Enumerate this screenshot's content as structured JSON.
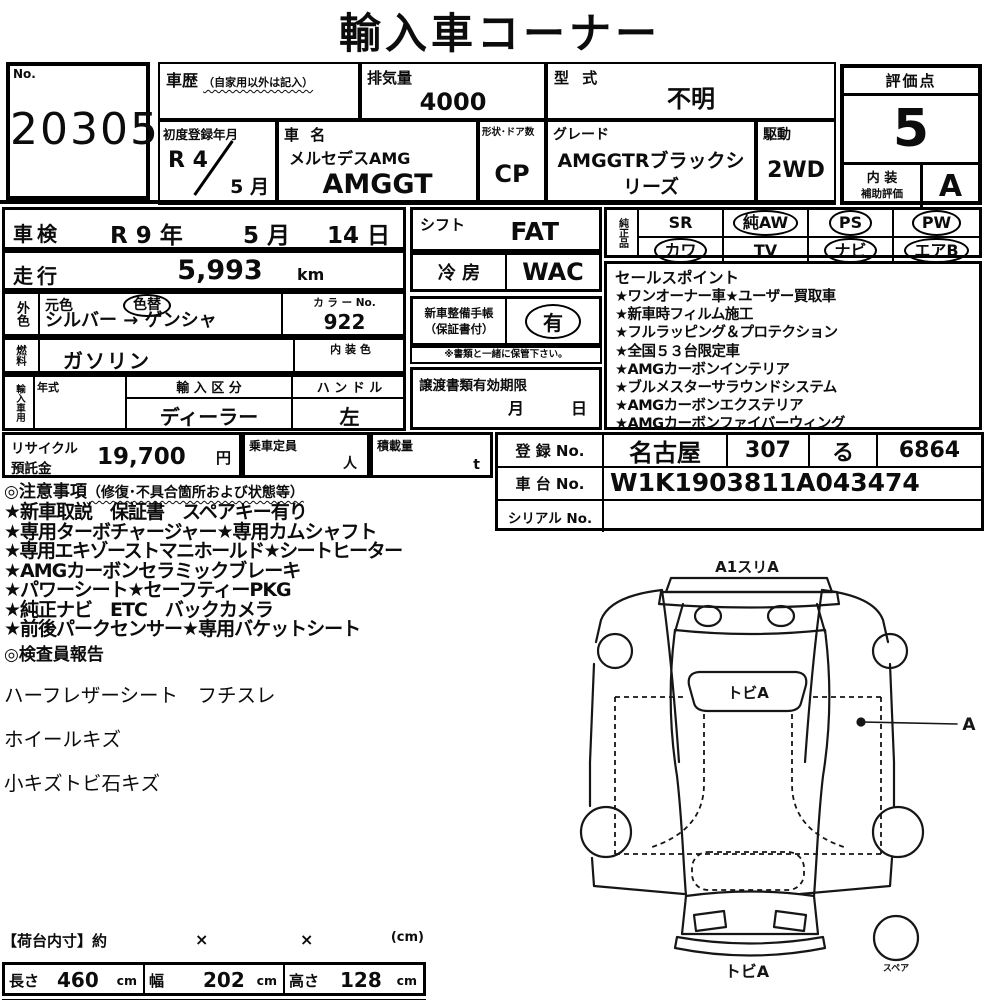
{
  "title": "輸入車コーナー",
  "no_box": {
    "label": "No.",
    "value": "20305"
  },
  "header": {
    "history": {
      "label": "車歴",
      "note": "（自家用以外は記入）",
      "value": ""
    },
    "displacement": {
      "label": "排気量",
      "value": "4000"
    },
    "model_code": {
      "label": "型 式",
      "value": "不明"
    },
    "first_reg": {
      "label": "初度登録年月",
      "year": "R 4",
      "month": "5 月"
    },
    "car_name": {
      "label": "車 名",
      "maker": "メルセデスAMG",
      "model": "AMGGT"
    },
    "body_doors": {
      "label": "形状･ドア数",
      "value": "CP"
    },
    "grade": {
      "label": "グレード",
      "value": "AMGGTRブラックシリーズ"
    },
    "drive": {
      "label": "駆動",
      "value": "2WD"
    }
  },
  "rating": {
    "label": "評価点",
    "score": "5",
    "interior_label1": "内 装",
    "interior_label2": "補助評価",
    "interior_score": "A"
  },
  "inspection": {
    "label": "車検",
    "year": "R 9 年",
    "month": "5 月",
    "day": "14 日"
  },
  "mileage": {
    "label": "走行",
    "value": "5,993",
    "unit": "km"
  },
  "exterior": {
    "label": "外色",
    "orig_label": "元色",
    "changed_badge": "色替",
    "value": "シルバー → ゲンシャ",
    "color_no_label": "カ ラ ー No.",
    "color_no": "922"
  },
  "fuel": {
    "label": "燃料",
    "value": "ガソリン",
    "interior_color_label": "内 装 色",
    "interior_color": ""
  },
  "import_info": {
    "label": "輸入車用",
    "year_label": "年式",
    "year": "",
    "kubun_label": "輸 入 区 分",
    "kubun": "ディーラー",
    "handle_label": "ハ ン ド ル",
    "handle": "左"
  },
  "shift": {
    "label": "シフト",
    "value": "FAT"
  },
  "aircon": {
    "label": "冷 房",
    "value": "WAC"
  },
  "service_book": {
    "label1": "新車整備手帳",
    "label2": "（保証書付）",
    "value": "有",
    "note": "※書類と一緒に保管下さい。"
  },
  "transfer_docs": {
    "label": "譲渡書類有効期限",
    "month": "月",
    "day": "日"
  },
  "oem_parts": {
    "label": "純正品",
    "items": [
      {
        "text": "SR",
        "circled": false
      },
      {
        "text": "純AW",
        "circled": true
      },
      {
        "text": "PS",
        "circled": true
      },
      {
        "text": "PW",
        "circled": true
      },
      {
        "text": "カワ",
        "circled": true
      },
      {
        "text": "TV",
        "circled": false
      },
      {
        "text": "ナビ",
        "circled": true
      },
      {
        "text": "エアB",
        "circled": true
      }
    ]
  },
  "sales_points": {
    "title": "セールスポイント",
    "items": [
      "★ワンオーナー車★ユーザー買取車",
      "★新車時フィルム施工",
      "★フルラッピング＆プロテクション",
      "★全国５３台限定車",
      "★AMGカーボンインテリア",
      "★ブルメスターサラウンドシステム",
      "★AMGカーボンエクステリア",
      "★AMGカーボンファイバーウィング"
    ]
  },
  "recycle": {
    "label1": "リサイクル",
    "label2": "預託金",
    "value": "19,700",
    "unit": "円"
  },
  "capacity": {
    "label": "乗車定員",
    "unit": "人"
  },
  "load": {
    "label": "積載量",
    "unit": "t"
  },
  "registration": {
    "reg_label": "登 録 No.",
    "reg_area": "名古屋",
    "reg_class": "307",
    "reg_kana": "る",
    "reg_number": "6864",
    "chassis_label": "車 台 No.",
    "chassis": "W1K1903811A043474",
    "serial_label": "シリアル No.",
    "serial": ""
  },
  "cautions": {
    "title": "◎注意事項",
    "title_note": "（修復･不具合箇所および状態等）",
    "items": [
      "★新車取説　保証書　スペアキー有り",
      "★専用ターボチャージャー★専用カムシャフト",
      "★専用エキゾーストマニホールド★シートヒーター",
      "★AMGカーボンセラミックブレーキ",
      "★パワーシート★セーフティーPKG",
      "★純正ナビ　ETC　バックカメラ",
      "★前後パークセンサー★専用バケットシート"
    ]
  },
  "inspector_report": {
    "title": "◎検査員報告",
    "items": [
      "ハーフレザーシート　フチスレ",
      "ホイールキズ",
      "小キズトビ石キズ"
    ]
  },
  "diagram": {
    "top_label": "A1スリA",
    "windshield_label": "トビA",
    "side_label": "A",
    "rear_label": "トビA",
    "spare_label": "スペア"
  },
  "cargo": {
    "title": "【荷台内寸】約",
    "times1": "×",
    "times2": "×",
    "unit_note": "(cm)",
    "length_label": "長さ",
    "length": "460",
    "length_unit": "cm",
    "width_label": "幅",
    "width": "202",
    "width_unit": "cm",
    "height_label": "高さ",
    "height": "128",
    "height_unit": "cm"
  }
}
